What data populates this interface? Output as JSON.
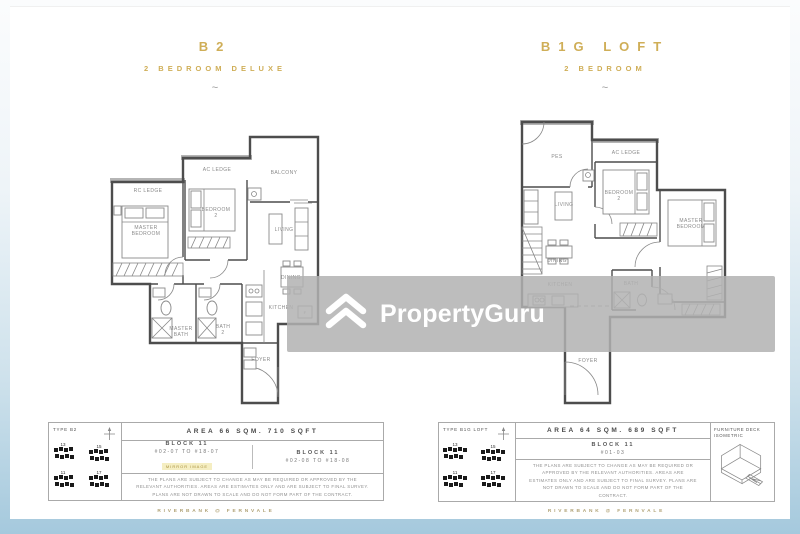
{
  "colors": {
    "accent_gold": "#cfae57",
    "frame_blue": "#a5c9dd",
    "watermark_bg": "#b1b1b1",
    "highlight_yellow": "#f5eec2"
  },
  "watermark": {
    "text": "PropertyGuru"
  },
  "project_name": "RIVERBANK @ FERNVALE",
  "units": [
    {
      "title": "B2",
      "subtitle": "2 BEDROOM DELUXE",
      "separator": "~",
      "type_label": "TYPE B2",
      "area_label": "AREA 66 SQM. 710 SQFT",
      "site_numbers": [
        "13",
        "15",
        "11",
        "17"
      ],
      "blocks": [
        {
          "name": "BLOCK 11",
          "range": "#02-07 TO #18-07",
          "tag": "MIRROR IMAGE"
        },
        {
          "name": "BLOCK 11",
          "range": "#02-08 TO #18-08"
        }
      ],
      "disclaimer": "THE PLANS ARE SUBJECT TO CHANGE AS MAY BE REQUIRED OR APPROVED BY THE RELEVANT AUTHORITIES. AREAS ARE ESTIMATES ONLY AND ARE SUBJECT TO FINAL SURVEY. PLANS ARE NOT DRAWN TO SCALE AND DO NOT FORM PART OF THE CONTRACT.",
      "rooms": {
        "rc_ledge": "RC LEDGE",
        "ac_ledge": "AC LEDGE",
        "balcony": "BALCONY",
        "master_bedroom": [
          "MASTER",
          "BEDROOM"
        ],
        "bedroom2": [
          "BEDROOM",
          "2"
        ],
        "living": "LIVING",
        "dining": "DINING",
        "kitchen": "KITCHEN",
        "master_bath": [
          "MASTER",
          "BATH"
        ],
        "bath2": [
          "BATH",
          "2"
        ],
        "foyer": "FOYER",
        "fridge": "F"
      }
    },
    {
      "title": "B1G LOFT",
      "subtitle": "2 BEDROOM",
      "separator": "~",
      "type_label": "TYPE B1G LOFT",
      "area_label": "AREA 64 SQM. 689 SQFT",
      "site_numbers": [
        "13",
        "15",
        "11",
        "17"
      ],
      "blocks": [
        {
          "name": "BLOCK 11",
          "range": "#01-03"
        }
      ],
      "furniture_deck_label": [
        "FURNITURE DECK",
        "ISOMETRIC"
      ],
      "disclaimer": "THE PLANS ARE SUBJECT TO CHANGE AS MAY BE REQUIRED OR APPROVED BY THE RELEVANT AUTHORITIES. AREAS ARE ESTIMATES ONLY AND ARE SUBJECT TO FINAL SURVEY. PLANS ARE NOT DRAWN TO SCALE AND DO NOT FORM PART OF THE CONTRACT.",
      "rooms": {
        "pes": "PES",
        "ac_ledge": "AC LEDGE",
        "bedroom2": [
          "BEDROOM",
          "2"
        ],
        "living": "LIVING",
        "master_bedroom": [
          "MASTER",
          "BEDROOM"
        ],
        "dining": "DINING",
        "kitchen": "KITCHEN",
        "bath": "BATH",
        "foyer": "FOYER"
      }
    }
  ]
}
